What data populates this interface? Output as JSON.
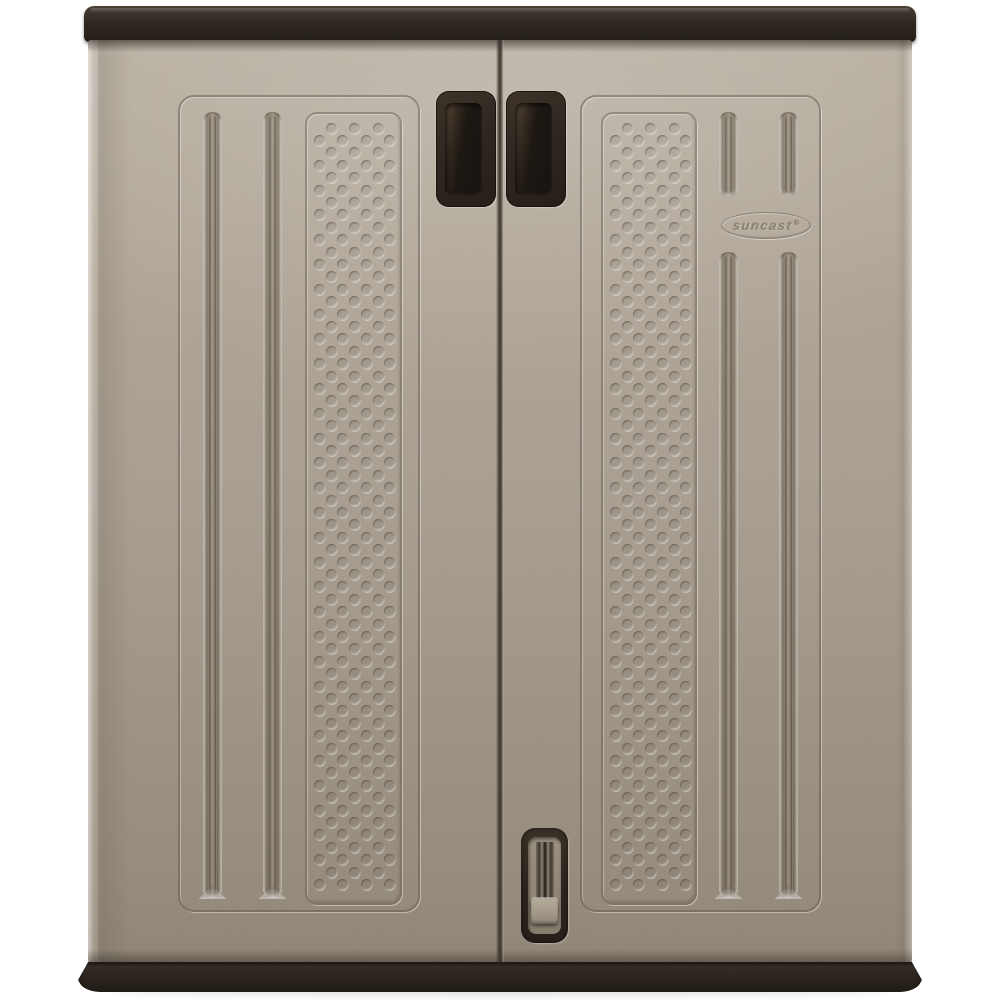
{
  "image": {
    "type": "product-photograph",
    "subject": "two-door resin utility base storage cabinet, front view",
    "background_color": "#ffffff"
  },
  "brand": {
    "logo_text": "suncast",
    "registered_mark": "®"
  },
  "palette": {
    "trim_dark_brown": "#2b241e",
    "handle_cavity": "#1a1511",
    "door_gray_light": "#b5ac9f",
    "door_gray_mid": "#a79e91",
    "door_gray_dark": "#948a7c",
    "groove_shadow": "#4a4135",
    "latch_plate_gray": "#93897a",
    "emboss_text_color": "#89806f",
    "background": "#ffffff"
  },
  "geometry": {
    "grooves": [
      {
        "door": "left",
        "x": 115,
        "y": 72,
        "w": 19,
        "h": 786,
        "foot": true
      },
      {
        "door": "left",
        "x": 175,
        "y": 72,
        "w": 19,
        "h": 786,
        "foot": true
      },
      {
        "door": "right",
        "x": 215,
        "y": 72,
        "w": 19,
        "h": 84,
        "foot": false
      },
      {
        "door": "right",
        "x": 275,
        "y": 72,
        "w": 19,
        "h": 84,
        "foot": false
      },
      {
        "door": "right",
        "x": 215,
        "y": 212,
        "w": 19,
        "h": 646,
        "foot": true
      },
      {
        "door": "right",
        "x": 275,
        "y": 212,
        "w": 19,
        "h": 646,
        "foot": true
      }
    ],
    "dimple_panels": [
      {
        "door": "left",
        "h": 793
      },
      {
        "door": "right",
        "h": 793
      }
    ],
    "dimple": {
      "d": 11,
      "row_pitch": 12.4,
      "start_y": 14,
      "cols3": [
        24,
        47.5,
        71
      ],
      "cols4": [
        12,
        35.5,
        59,
        82.5
      ]
    }
  }
}
